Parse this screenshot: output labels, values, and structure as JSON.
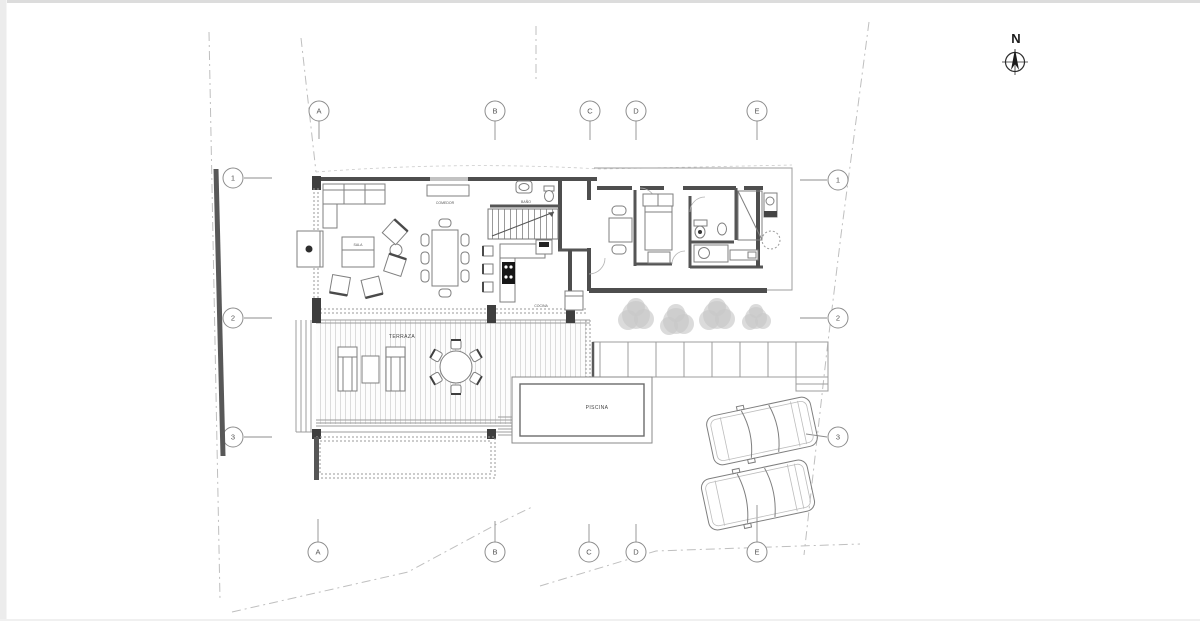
{
  "north_indicator": {
    "label": "N"
  },
  "grid": {
    "columns": [
      "A",
      "B",
      "C",
      "D",
      "E"
    ],
    "rows": [
      "1",
      "2",
      "3"
    ]
  },
  "rooms": {
    "comedor": "COMEDOR",
    "sala": "SALA",
    "cocina": "COCINA",
    "banio": "BAÑO",
    "terraza": "TERRAZA",
    "piscina": "PISCINA"
  },
  "colors": {
    "wall": "#4e4e4e",
    "property_line": "#bfbfbf",
    "deck_plank": "#dadada",
    "tree": "#c7c7c7",
    "paper": "#ffffff"
  }
}
